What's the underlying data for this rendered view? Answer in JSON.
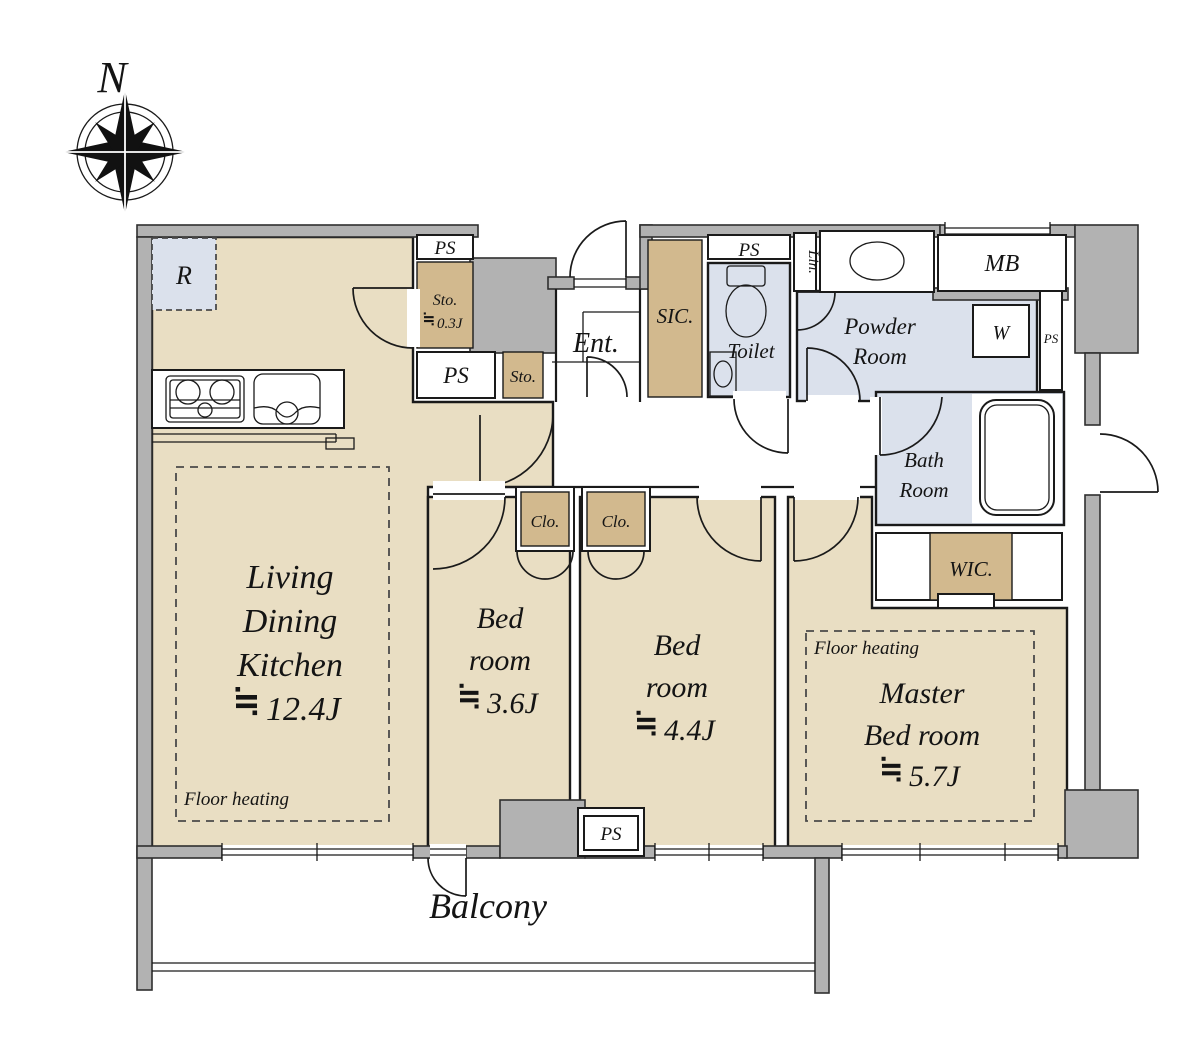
{
  "compass": {
    "north_label": "N"
  },
  "symbols": {
    "approx_equal": "≒"
  },
  "rooms": {
    "ldk": {
      "line1": "Living",
      "line2": "Dining",
      "line3": "Kitchen",
      "area": "12.4J",
      "floor_heating": "Floor heating"
    },
    "bedroom1": {
      "line1": "Bed",
      "line2": "room",
      "area": "3.6J"
    },
    "bedroom2": {
      "line1": "Bed",
      "line2": "room",
      "area": "4.4J"
    },
    "master_bedroom": {
      "line1": "Master",
      "line2": "Bed room",
      "area": "5.7J",
      "floor_heating": "Floor heating"
    },
    "entrance": {
      "label": "Ent."
    },
    "toilet": {
      "label": "Toilet"
    },
    "powder_room": {
      "line1": "Powder",
      "line2": "Room"
    },
    "bath_room": {
      "line1": "Bath",
      "line2": "Room"
    },
    "balcony": {
      "label": "Balcony"
    }
  },
  "storage": {
    "sic": {
      "label": "SIC."
    },
    "wic": {
      "label": "WIC."
    },
    "sto_small": {
      "label": "Sto.",
      "area": "0.3J"
    },
    "sto": {
      "label": "Sto."
    },
    "clo1": {
      "label": "Clo."
    },
    "clo2": {
      "label": "Clo."
    },
    "lin": {
      "label": "Lin."
    }
  },
  "utility": {
    "ps": "PS",
    "mb": "MB",
    "washer": "W",
    "refrigerator": "R"
  }
}
